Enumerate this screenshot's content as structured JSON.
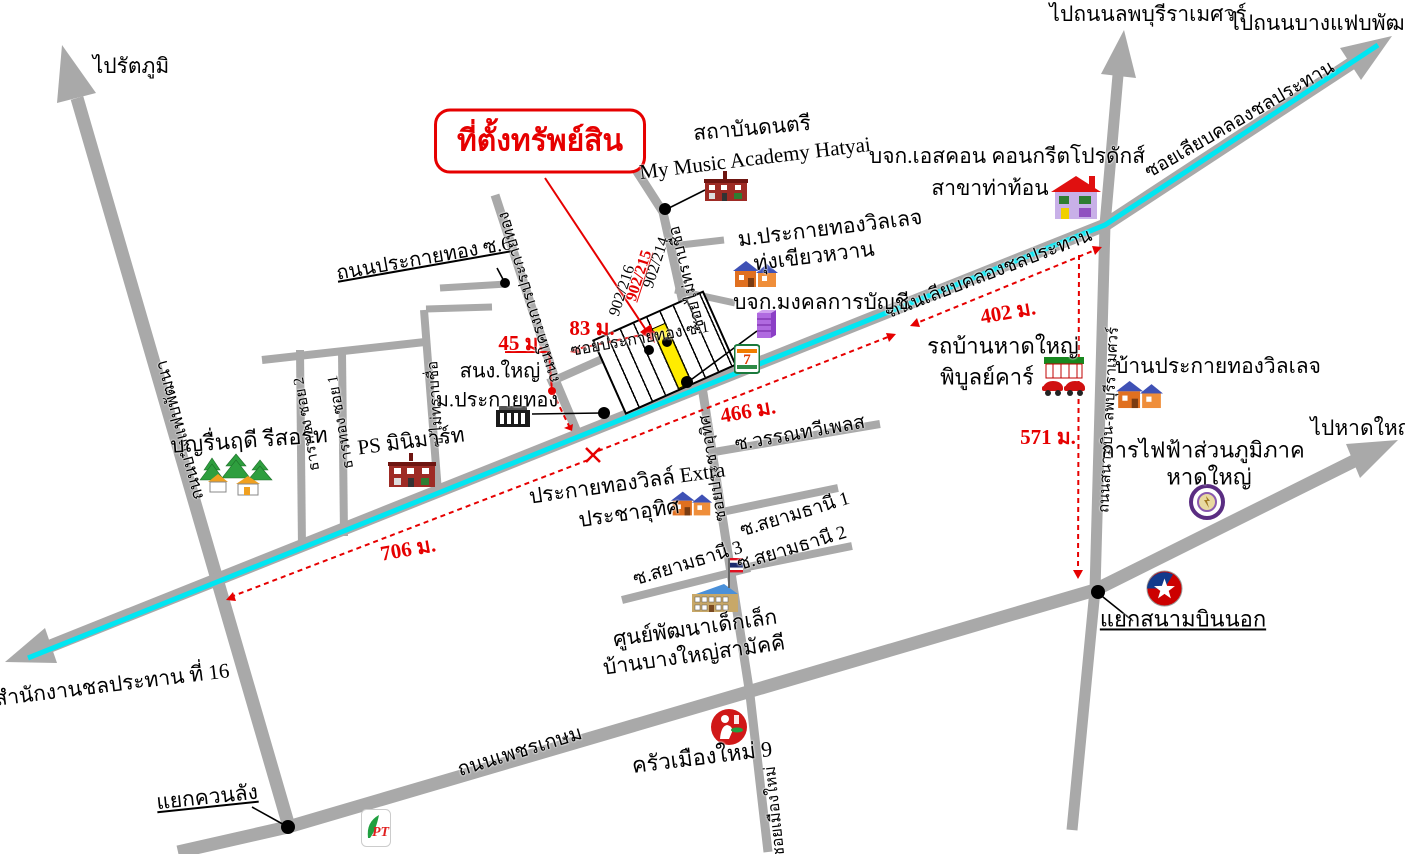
{
  "colors": {
    "road": "#a9a9a9",
    "canal": "#00e6f2",
    "accent_red": "#e60000",
    "highlight_plot": "#ffec00"
  },
  "property": {
    "box_label": "ที่ตั้งทรัพย์สิน",
    "house_no_left": "902/216",
    "house_no_mid": "902/215",
    "house_no_right": "902/214"
  },
  "exits": {
    "rattaphum": "ไปรัตภูมิ",
    "lopburi": "ไปถนนลพบุรีราเมศวร์",
    "bangfaep": "ไปถนนบางแฟบพัฒนา",
    "hatyai": "ไปหาดใหญ่",
    "irrigation": "ไปสำนักงานชลประทาน ที่ 16"
  },
  "junctions": {
    "airport": "แยกสนามบินนอก",
    "khuanlang": "แยกควนลัง"
  },
  "distances": {
    "d83": "83 ม.",
    "d45": "45 ม.",
    "d402": "402 ม.",
    "d466": "466 ม.",
    "d571": "571 ม.",
    "d706": "706 ม."
  },
  "roads": {
    "canal_road": "ถนนเลียบคลองชลประทาน",
    "canal_soi": "ซอยเลียบคลองชลประทาน",
    "phetkasem": "ถนนเพชรเกษม",
    "bangfaep_phatthana": "ถนนบางแฟบพัฒนา",
    "sanambin_lopburi": "ถนนสนามบิน-ลพบุรีราเมศวร์",
    "prakaithong_soi6": "ถนนประกายทอง ซ.6",
    "prakaithong_soi1": "ซอยประกายทอง ซ.1",
    "prakaithong_project": "ถนนโครงการประกายทอง",
    "soi_unknown_long": "ซอยไม่ทราบชื่อ",
    "soi_unknown_short": "ซ.ไม่ทราบชื่อ",
    "prachautit": "ซอยประชาอุทิศ",
    "muangmai": "ซอยเมืองใหม่",
    "thanthong2": "ธารทอง ซอย 2",
    "thanthong1": "ธารทอง ซอย 1",
    "wannathawee": "ซ.วรรณทวีเพลส",
    "siam1": "ซ.สยามธานี 1",
    "siam2": "ซ.สยามธานี 2",
    "siam3": "ซ.สยามธานี 3"
  },
  "places": {
    "music_line1": "สถาบันดนตรี",
    "music_line2": "My Music Academy Hatyai",
    "escon_line1": "บจก.เอสคอน คอนกรีตโปรดักส์",
    "escon_line2": "สาขาท่าท้อน",
    "village": "ม.ประกายทองวิลเลจ",
    "thungkhiao": "ทุ่งเขียวหวาน",
    "mongkol": "บจก.มงคลการบัญชี",
    "sng_line1": "สนง.ใหญ่",
    "sng_line2": "ม.ประกายทอง",
    "ps": "PS มินิมาร์ท",
    "resort": "บุญรื่นฤดี รีสอร์ท",
    "rotban_line1": "รถบ้านหาดใหญ่",
    "rotban_line2": "พิบูลย์คาร์",
    "banprakai": "บ้านประกายทองวิลเลจ",
    "pea_line1": "การไฟฟ้าส่วนภูมิภาค",
    "pea_line2": "หาดใหญ่",
    "extra_line1": "ประกายทองวิลล์ Extra",
    "extra_line2": "ประชาอุทิศ",
    "childcare_line1": "ศูนย์พัฒนาเด็กเล็ก",
    "childcare_line2": "บ้านบางใหญ่สามัคคี",
    "krua": "ครัวเมืองใหม่ 9"
  },
  "icons": {
    "seven_eleven_glyph": "7",
    "pt_glyph": "PT"
  }
}
